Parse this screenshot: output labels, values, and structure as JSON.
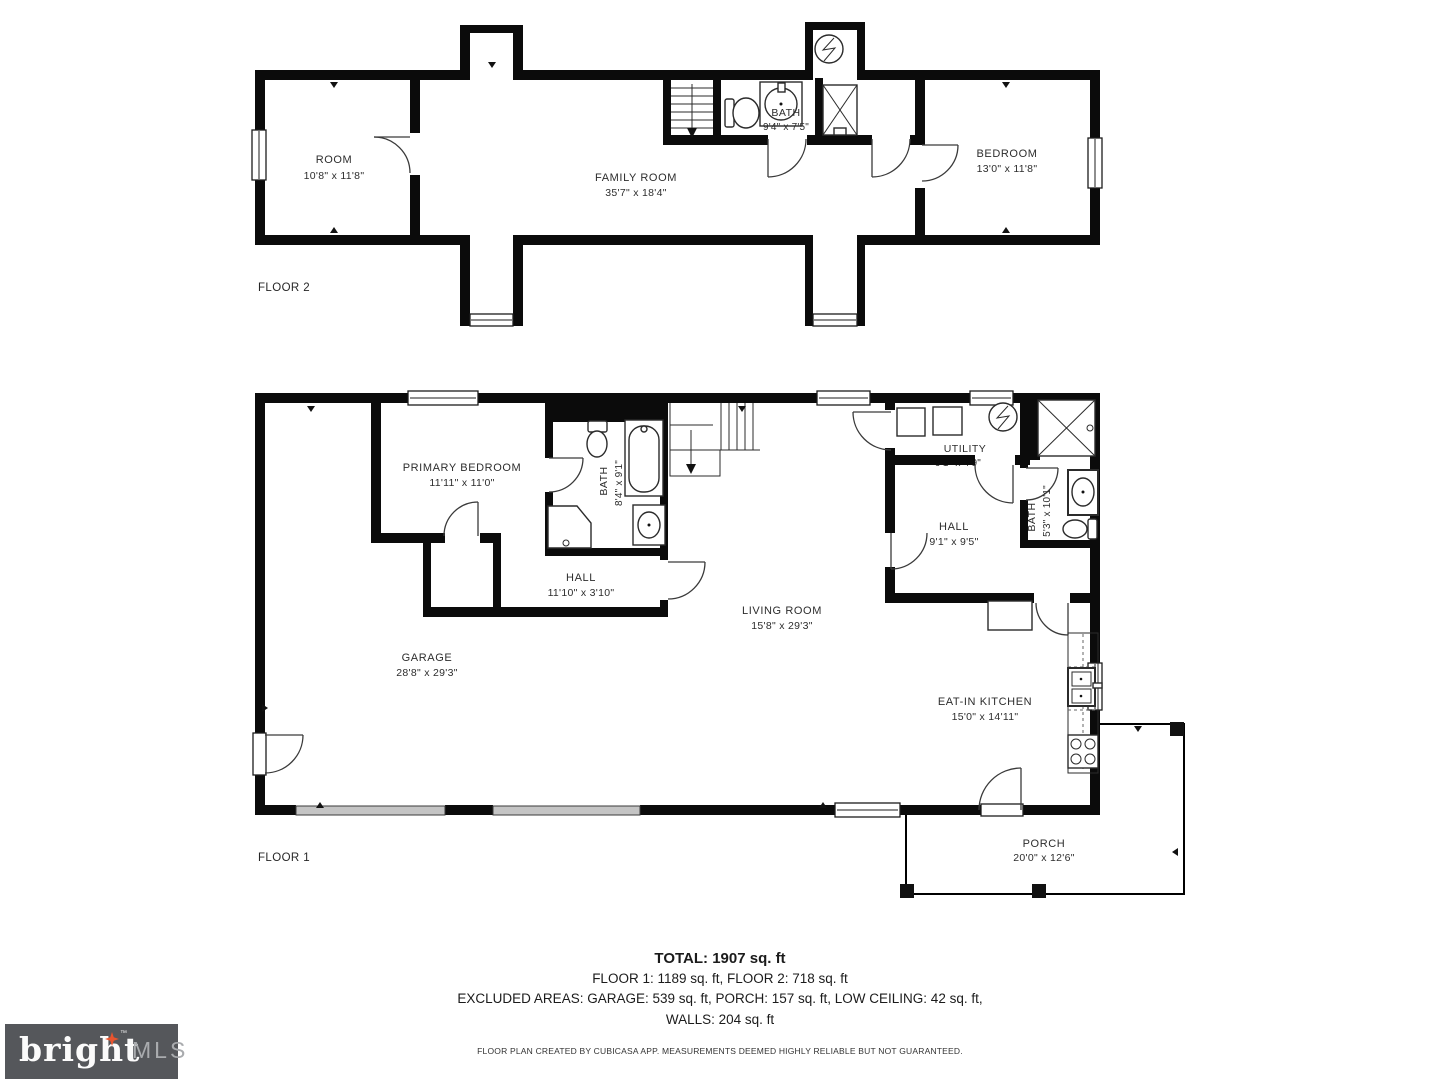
{
  "floor2": {
    "label": "FLOOR 2",
    "room": {
      "name": "ROOM",
      "dims": "10'8\" x 11'8\""
    },
    "family_room": {
      "name": "FAMILY ROOM",
      "dims": "35'7\" x 18'4\""
    },
    "bath": {
      "name": "BATH",
      "dims": "9'4\" x 7'5\""
    },
    "bedroom": {
      "name": "BEDROOM",
      "dims": "13'0\" x 11'8\""
    }
  },
  "floor1": {
    "label": "FLOOR 1",
    "primary_bedroom": {
      "name": "PRIMARY BEDROOM",
      "dims": "11'11\" x 11'0\""
    },
    "bath": {
      "name": "BATH",
      "dims": "8'4\" x 9'1\""
    },
    "hall": {
      "name": "HALL",
      "dims": "11'10\" x 3'10\""
    },
    "garage": {
      "name": "GARAGE",
      "dims": "28'8\" x 29'3\""
    },
    "living_room": {
      "name": "LIVING ROOM",
      "dims": "15'8\" x 29'3\""
    },
    "utility": {
      "name": "UTILITY",
      "dims": "9'1\" x 4'9\""
    },
    "hall2": {
      "name": "HALL",
      "dims": "9'1\" x 9'5\""
    },
    "bath2": {
      "name": "BATH",
      "dims": "5'3\" x 10'1\""
    },
    "eat_in_kitchen": {
      "name": "EAT-IN KITCHEN",
      "dims": "15'0\" x 14'11\""
    },
    "porch": {
      "name": "PORCH",
      "dims": "20'0\" x 12'6\""
    }
  },
  "summary": {
    "total": "TOTAL: 1907 sq. ft",
    "floors": "FLOOR 1: 1189 sq. ft, FLOOR 2: 718 sq. ft",
    "excluded": "EXCLUDED AREAS: GARAGE: 539 sq. ft, PORCH: 157 sq. ft, LOW CEILING: 42 sq. ft,",
    "walls": "WALLS: 204 sq. ft",
    "disclaimer": "FLOOR PLAN CREATED BY CUBICASA APP. MEASUREMENTS DEEMED HIGHLY RELIABLE BUT NOT GUARANTEED."
  },
  "logo": {
    "brand": "bright",
    "tm": "™",
    "suffix": "MLS"
  },
  "colors": {
    "wall": "#0b0b0b",
    "accent": "#e8542e",
    "logo_bg": "#55575b"
  }
}
